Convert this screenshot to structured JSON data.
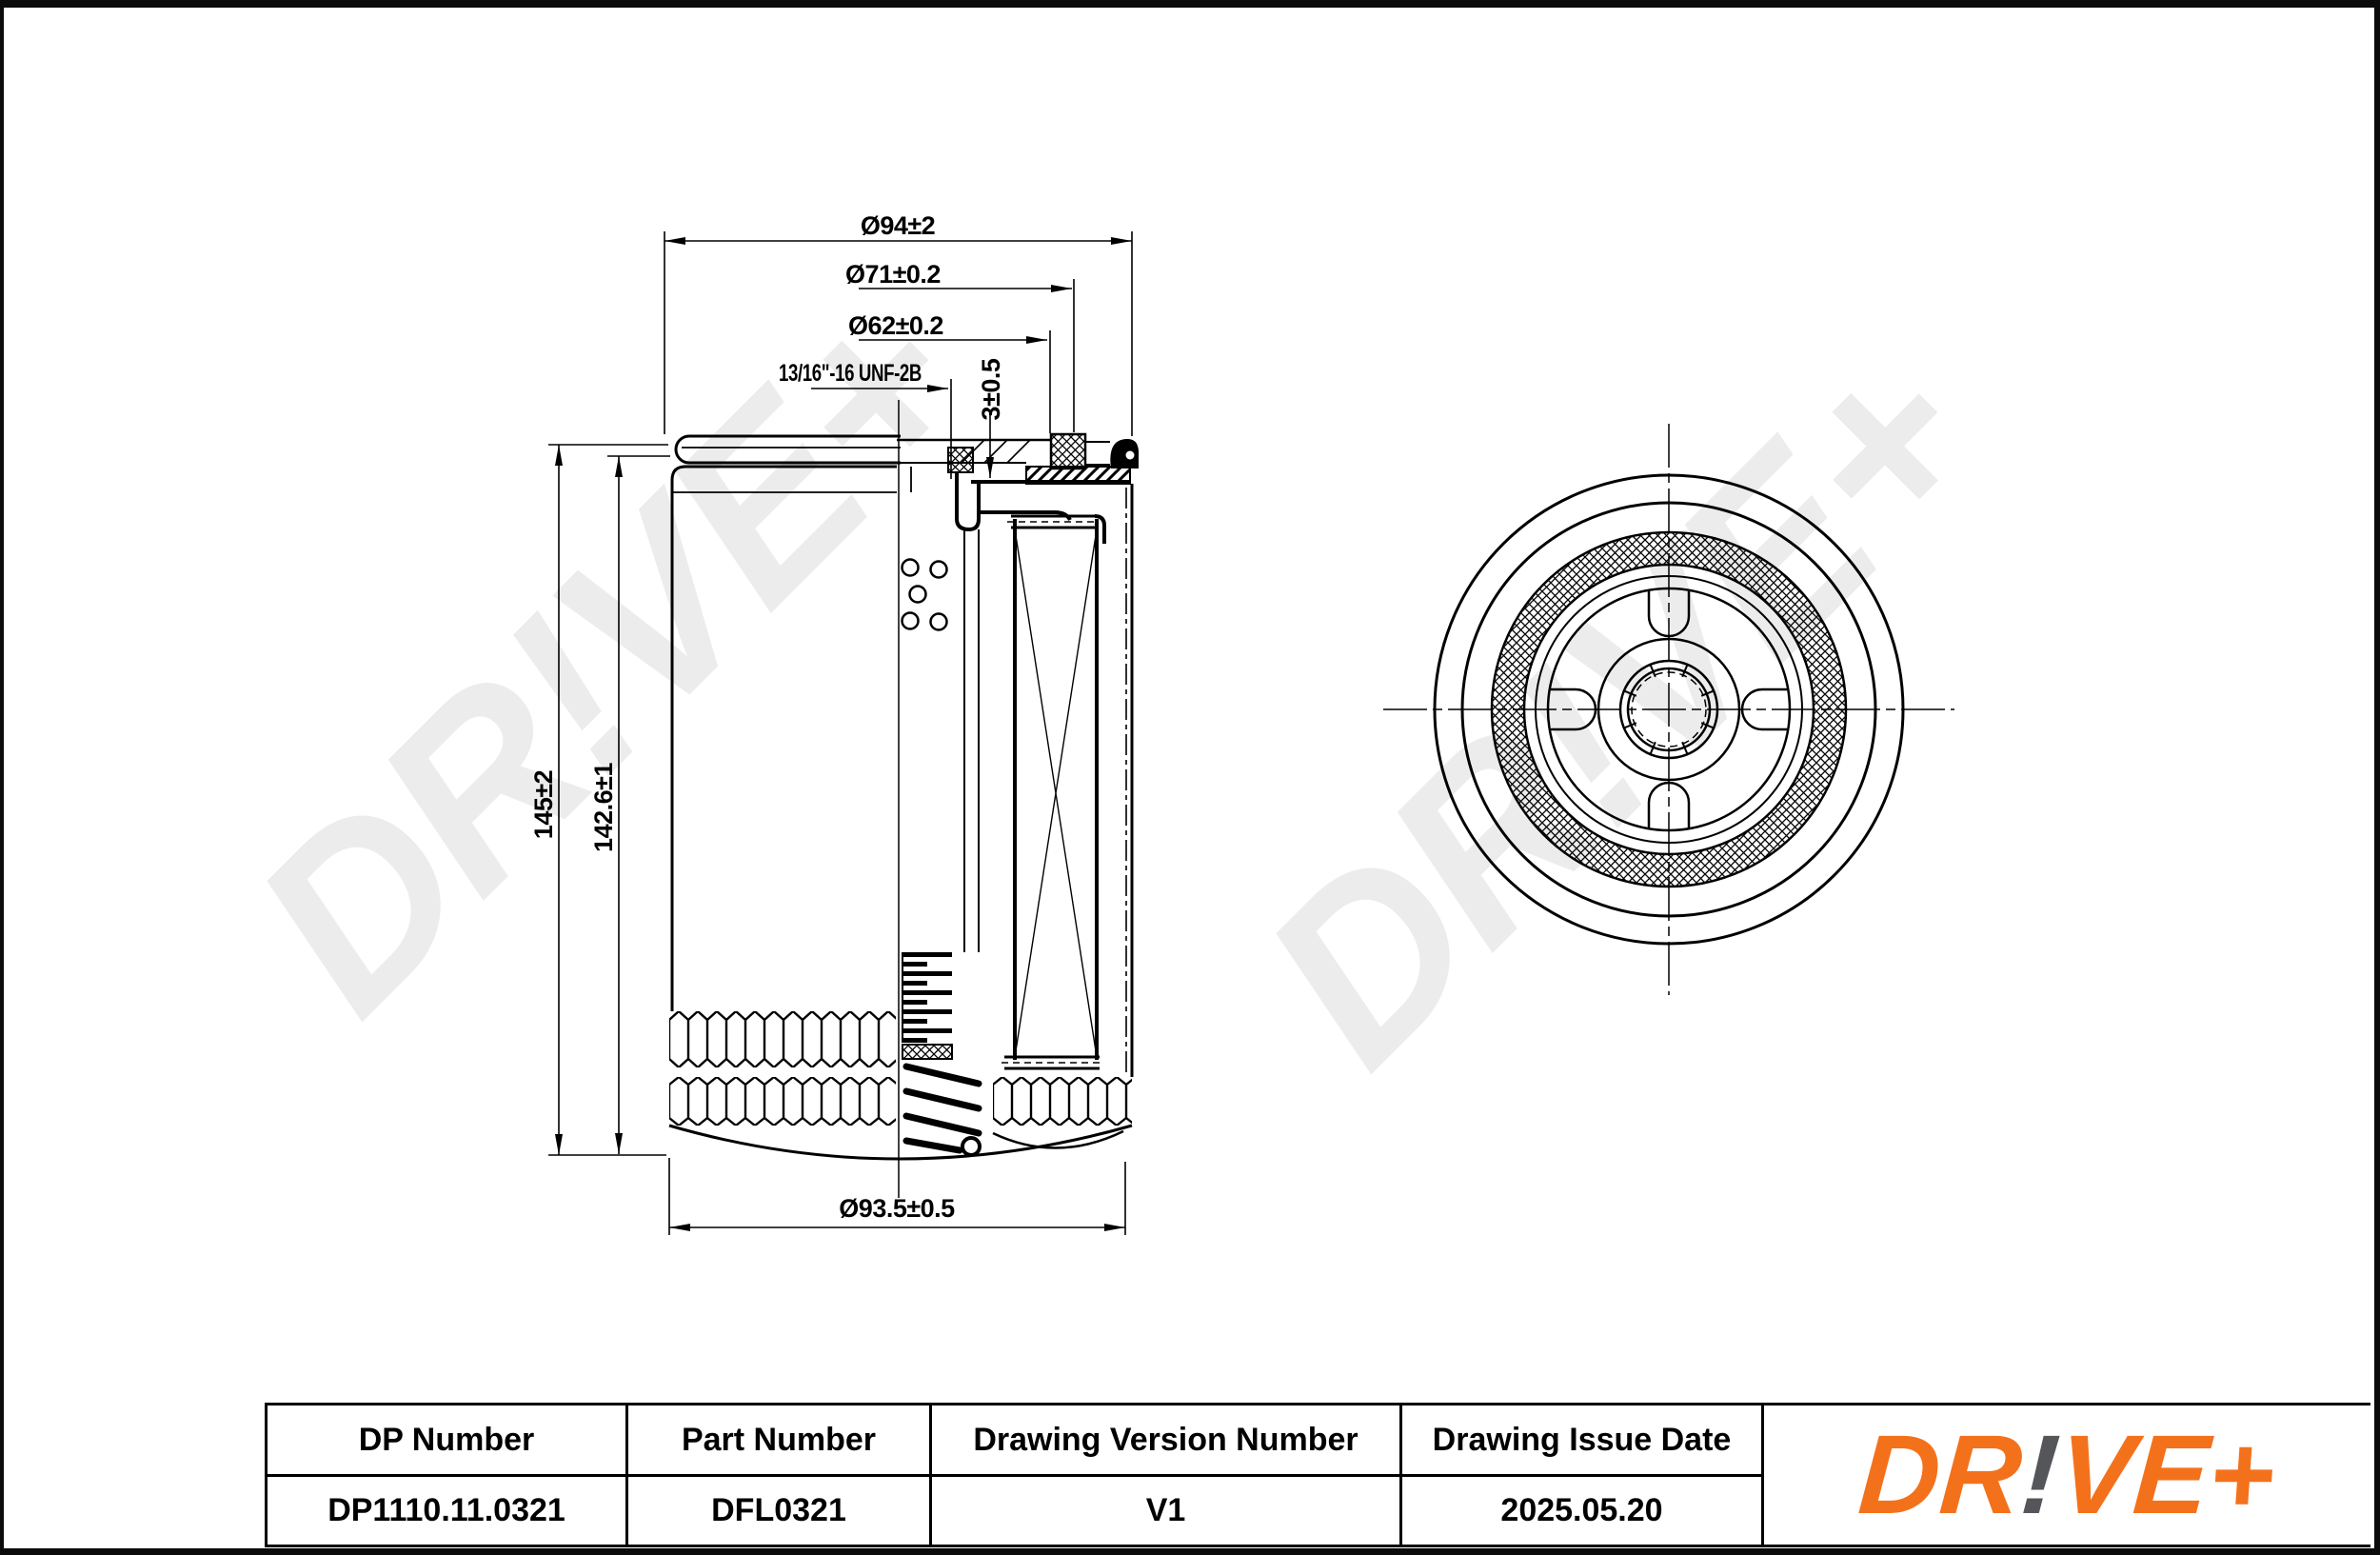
{
  "watermark": {
    "text": "DR!VE+",
    "color": "#ececec"
  },
  "drawing": {
    "dimensions": {
      "d94": "Ø94±2",
      "d71": "Ø71±0.2",
      "d62": "Ø62±0.2",
      "thread": "13/16\"-16 UNF-2B",
      "gasket_height": "3±0.5",
      "height_overall": "145±2",
      "height_body": "142.6±1",
      "d935": "Ø93.5±0.5"
    },
    "line_color": "#000000"
  },
  "title_block": {
    "columns": [
      {
        "header": "DP Number",
        "value": "DP1110.11.0321"
      },
      {
        "header": "Part Number",
        "value": "DFL0321"
      },
      {
        "header": "Drawing Version Number",
        "value": "V1"
      },
      {
        "header": "Drawing Issue Date",
        "value": "2025.05.20"
      }
    ]
  },
  "logo": {
    "part1": "DR",
    "bang": "!",
    "part2": "VE+",
    "orange": "#F4711C",
    "gray": "#55565A"
  }
}
